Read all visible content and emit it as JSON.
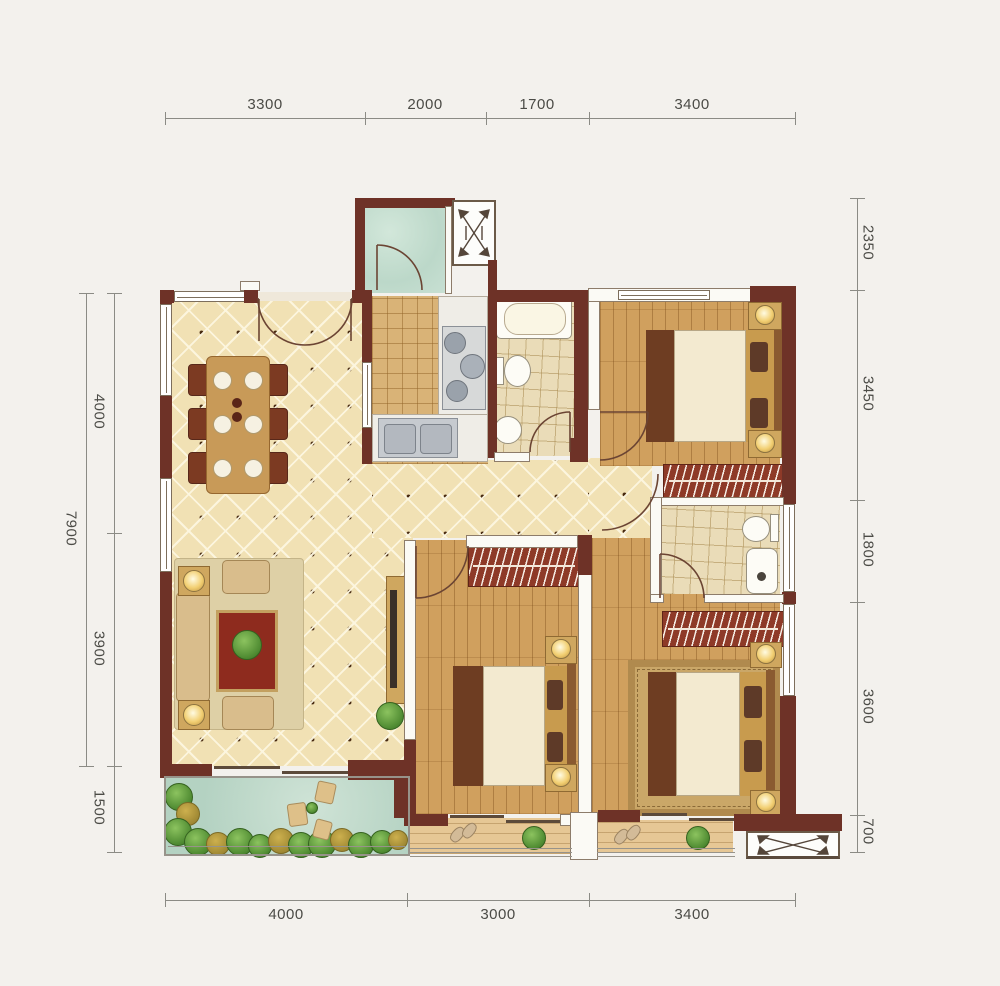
{
  "plan": {
    "type": "apartment-floor-plan"
  },
  "dimensions": {
    "top": [
      "3300",
      "2000",
      "1700",
      "3400"
    ],
    "bottom": [
      "4000",
      "3000",
      "3400"
    ],
    "left": [
      "4000",
      "3900",
      "1500"
    ],
    "left_total": "7900",
    "right": [
      "2350",
      "3450",
      "1800",
      "3600",
      "700"
    ]
  },
  "colors": {
    "wall": "#6e3227",
    "tile_floor": "#f1e1b4",
    "kitchen_tile": "#d9b377",
    "wood_floor": "#d0a05e",
    "utility_teal": "#bcd8c9",
    "garden_water": "#b4d2c2",
    "wardrobe_red": "#8e3a28",
    "background": "#f3f1ed"
  },
  "icons": {
    "ac_platform": "crossed-arrows-box",
    "door_swing": "quarter-arc"
  }
}
